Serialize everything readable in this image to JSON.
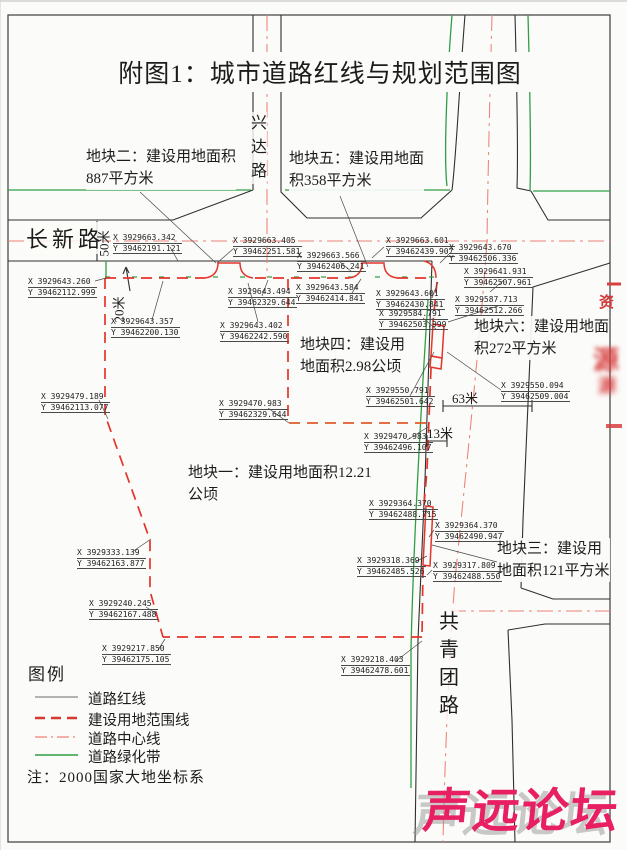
{
  "page": {
    "title": "附图1：城市道路红线与规划范围图"
  },
  "roads": {
    "changxin": "长新路",
    "xingda_chars": [
      "兴",
      "达",
      "路"
    ],
    "gongqingtuan_chars": [
      "共",
      "青",
      "团",
      "路"
    ]
  },
  "parcel_labels": [
    {
      "line1": "地块一：建设用地面积12.21",
      "line2": "公顷"
    },
    {
      "line1": "地块二：建设用地面积",
      "line2": "887平方米"
    },
    {
      "line1": "地块三：建设用",
      "line2": "地面积121平方米"
    },
    {
      "line1": "地块四：建设用",
      "line2": "地面积2.98公顷"
    },
    {
      "line1": "地块五：建设用地面",
      "line2": "积358平方米"
    },
    {
      "line1": "地块六：建设用地面",
      "line2": "积272平方米"
    }
  ],
  "dimensions": {
    "changxin_width": "50米",
    "setback": "20米",
    "dim_63": "63米",
    "dim_13": "13米"
  },
  "coordinate_labels": [
    {
      "x": "X 3929663.342",
      "y": "Y 39462191.121"
    },
    {
      "x": "X 3929663.405",
      "y": "Y 39462251.581"
    },
    {
      "x": "X 3929663.566",
      "y": "Y 39462406.241"
    },
    {
      "x": "X 3929663.601",
      "y": "Y 39462439.907"
    },
    {
      "x": "X 3929643.670",
      "y": "Y 39462506.336"
    },
    {
      "x": "X 3929643.260",
      "y": "Y 39462112.999"
    },
    {
      "x": "X 3929641.931",
      "y": "Y 39462507.961"
    },
    {
      "x": "X 3929643.494",
      "y": "Y 39462329.644"
    },
    {
      "x": "X 3929643.584",
      "y": "Y 39462414.841"
    },
    {
      "x": "X 3929643.601",
      "y": "Y 39462430.841"
    },
    {
      "x": "X 3929587.713",
      "y": "Y 39462512.266"
    },
    {
      "x": "X 3929584.791",
      "y": "Y 39462503.999"
    },
    {
      "x": "X 3929643.357",
      "y": "Y 39462200.130"
    },
    {
      "x": "X 3929643.402",
      "y": "Y 39462242.590"
    },
    {
      "x": "X 3929550.791",
      "y": "Y 39462501.642"
    },
    {
      "x": "X 3929550.094",
      "y": "Y 39462509.004"
    },
    {
      "x": "X 3929479.189",
      "y": "Y 39462113.077"
    },
    {
      "x": "X 3929470.983",
      "y": "Y 39462329.644"
    },
    {
      "x": "X 3929470.983",
      "y": "Y 39462496.107"
    },
    {
      "x": "X 3929364.370",
      "y": "Y 39462488.715"
    },
    {
      "x": "X 3929364.370",
      "y": "Y 39462490.947"
    },
    {
      "x": "X 3929333.139",
      "y": "Y 39462163.877"
    },
    {
      "x": "X 3929318.369",
      "y": "Y 39462485.526"
    },
    {
      "x": "X 3929317.809",
      "y": "Y 39462488.550"
    },
    {
      "x": "X 3929240.245",
      "y": "Y 39462167.488"
    },
    {
      "x": "X 3929217.850",
      "y": "Y 39462175.105"
    },
    {
      "x": "X 3929218.403",
      "y": "Y 39462478.601"
    }
  ],
  "legend": {
    "title": "图例",
    "items": [
      {
        "label": "道路红线",
        "color": "#9a9a9a"
      },
      {
        "label": "建设用地范围线",
        "color": "#d9372f"
      },
      {
        "label": "道路中心线",
        "color": "#e87c74"
      },
      {
        "label": "道路绿化带",
        "color": "#2f9e44"
      }
    ],
    "note": "注：2000国家大地坐标系"
  },
  "stamp": {
    "text_fragment": "资",
    "blob_fragment": "源"
  },
  "watermark": {
    "text": "声远论坛",
    "color": "#e81f63"
  }
}
